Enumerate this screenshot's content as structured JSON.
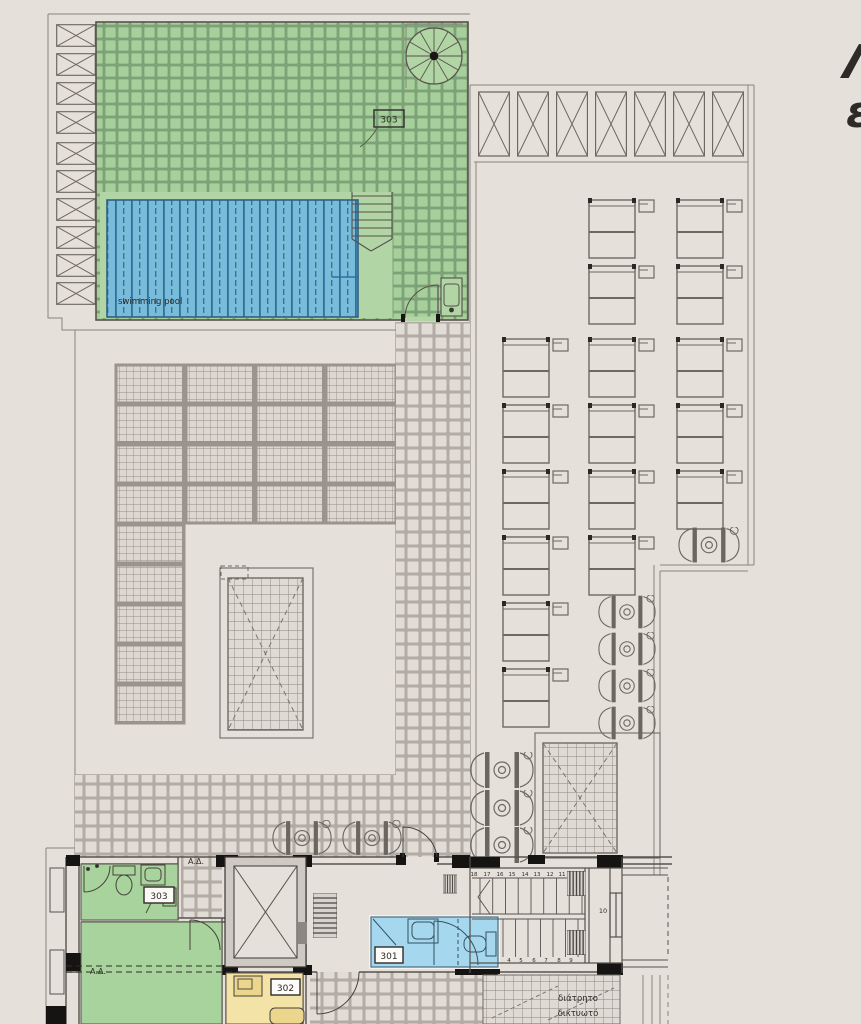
{
  "plan": {
    "pool_label": "swimming pool",
    "roof_unit_label": "303",
    "room_green_label": "303",
    "room_yellow_label": "302",
    "room_blue_label": "301",
    "marker_top": "Α.Δ.",
    "marker_mid": "Α.Δ.",
    "stair_upper": [
      "18",
      "17",
      "16",
      "15",
      "14",
      "13",
      "12",
      "11"
    ],
    "stair_lower": [
      "4",
      "5",
      "6",
      "7",
      "8",
      "9"
    ],
    "stair_mid": "10",
    "mesh_note": [
      "διάτρητο",
      "δικτυωτό",
      "πλέγμα"
    ],
    "edge_glyphs": [
      "Λ",
      "ε"
    ],
    "colors": {
      "paper": "#e6e0db",
      "ink": "#57524c",
      "roof_green": "#a6cf9b",
      "roof_green_plain": "#b2d5a6",
      "pool_blue": "#79bcd9",
      "pool_stripe": "#2f6f9f",
      "room_green": "#a9d39d",
      "room_yellow": "#f4e3a7",
      "room_blue": "#a5d7ee",
      "tile_joint": "#b0a9a2",
      "wall": "#161412"
    }
  }
}
